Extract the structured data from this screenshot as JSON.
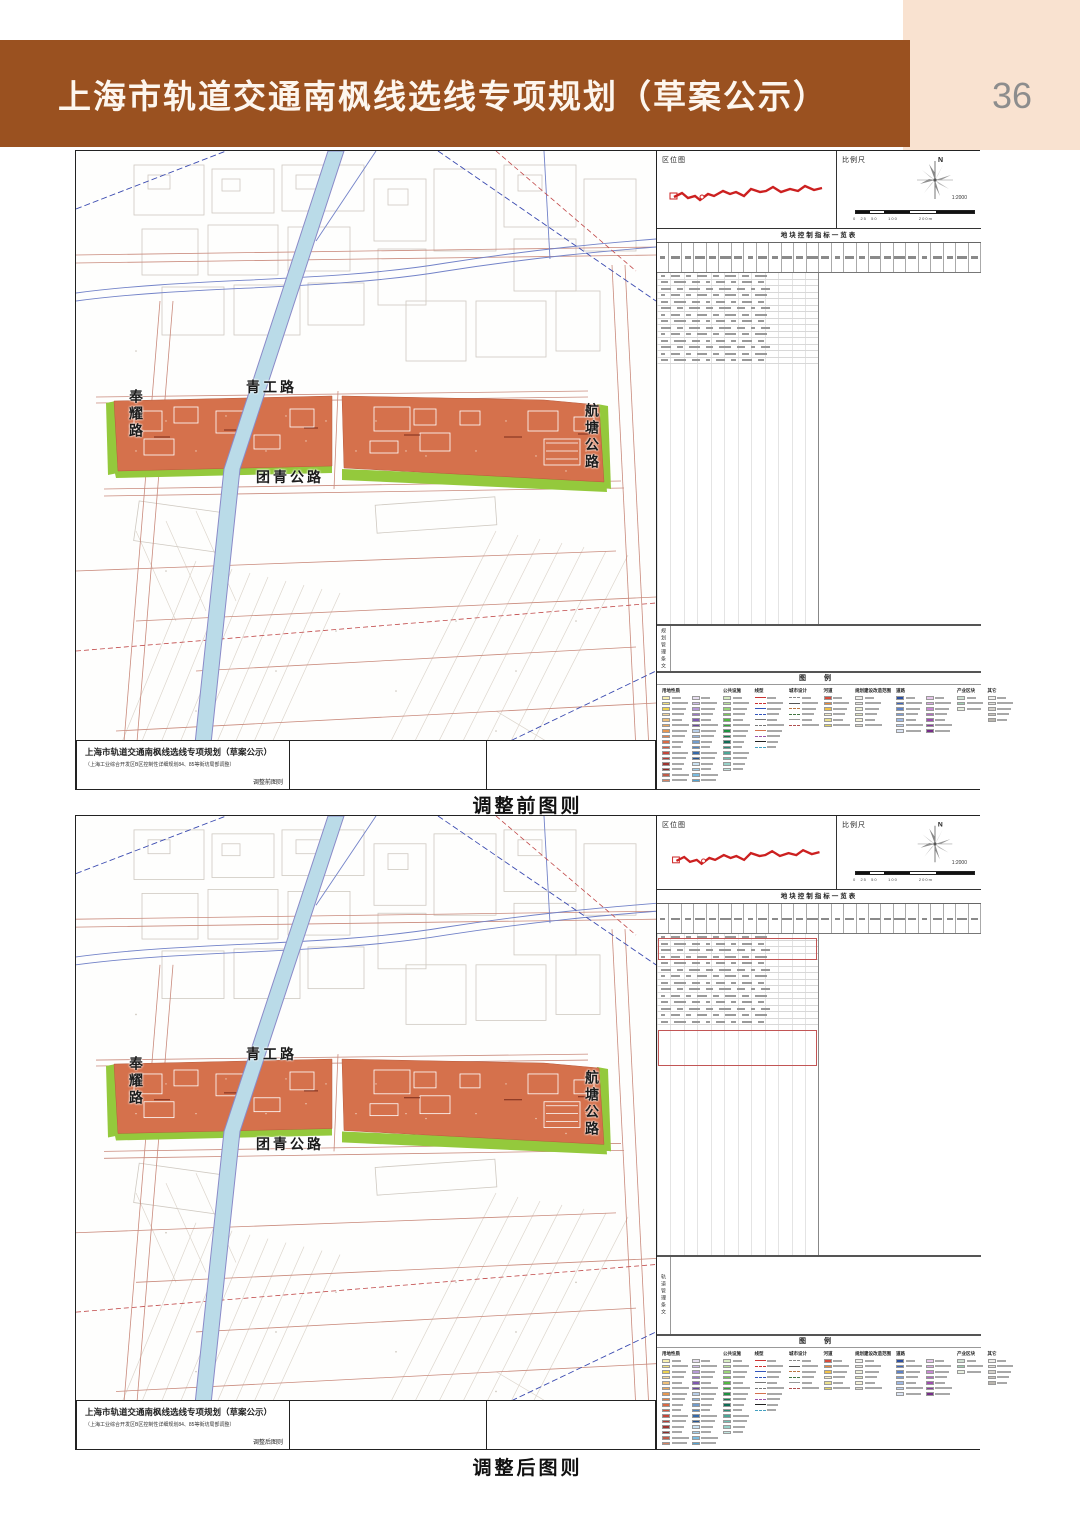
{
  "page": {
    "title": "上海市轨道交通南枫线选线专项规划（草案公示）",
    "page_number": "36"
  },
  "colors": {
    "header_brown": "#9a5120",
    "corner_peach": "#f9e2d0",
    "parcel_orange": "#d5714c",
    "greenbelt_green": "#94c93c",
    "canal_blue": "#badbe8",
    "route_red": "#cc2020"
  },
  "panels": [
    {
      "caption": "调整前图则",
      "location_map_label": "区位图",
      "scale_label": "比例尺",
      "north_label": "N",
      "scale_value": "1:2000",
      "scale_ticks": "0  25  50     100          200m",
      "table_title": "地块控制指标一览表",
      "conditions_label": "规划管理条文",
      "legend_title": "图 例",
      "roads": {
        "fengyao": "奉耀路",
        "qinggong": "青工路",
        "tuanqing": "团青公路",
        "hangtang": "航塘公路"
      },
      "titleblock": {
        "line1": "上海市轨道交通南枫线选线专项规划（草案公示）",
        "line2": "（上海工业综合开发区B区控制性详细规划84、85等街坊局部调整）",
        "line3": "调整前图则"
      }
    },
    {
      "caption": "调整后图则",
      "location_map_label": "区位图",
      "scale_label": "比例尺",
      "north_label": "N",
      "scale_value": "1:2000",
      "scale_ticks": "0  25  50     100          200m",
      "table_title": "地块控制指标一览表",
      "conditions_label": "轨道管理条文",
      "legend_title": "图 例",
      "roads": {
        "fengyao": "奉耀路",
        "qinggong": "青工路",
        "tuanqing": "团青公路",
        "hangtang": "航塘公路"
      },
      "titleblock": {
        "line1": "上海市轨道交通南枫线选线专项规划（草案公示）",
        "line2": "（上海工业综合开发区B区控制性详细规划84、85等街坊局部调整）",
        "line3": "调整后图则"
      }
    }
  ],
  "legend": {
    "sections": [
      {
        "title": "用地性质",
        "type": "swatch",
        "cols": [
          [
            "#f7efb0",
            "#f2e17f",
            "#ecd24f",
            "#f3d79c",
            "#efc079",
            "#eca85c",
            "#e79750",
            "#e1814b",
            "#da6a45",
            "#d2553f",
            "#c4463a",
            "#b23c35",
            "#9e3430",
            "#8a2b2b",
            "#c05c49",
            "#d68465"
          ],
          [
            "#e7def0",
            "#d0bde6",
            "#b699d6",
            "#9a75c4",
            "#7f58b1",
            "#68479c",
            "#b9cfe9",
            "#95b4da",
            "#719ccc",
            "#4f83bd",
            "#3569aa",
            "#265493",
            "#cbe3f3",
            "#a3d0ec",
            "#79bce1",
            "#53a4d2"
          ]
        ]
      },
      {
        "title": "公共设施",
        "type": "swatch",
        "cols": [
          [
            "#d8eec2",
            "#bae19d",
            "#9ad478",
            "#77c757",
            "#52b842",
            "#33a537",
            "#1e9140",
            "#137d4e",
            "#106b55",
            "#2b8c78",
            "#4ba697",
            "#70bfb2",
            "#98d3ca",
            "#c1e5df"
          ]
        ]
      },
      {
        "title": "线型",
        "type": "line",
        "cols": [
          [
            {
              "color": "#cc3333",
              "dash": false
            },
            {
              "color": "#cc3333",
              "dash": true
            },
            {
              "color": "#3355bb",
              "dash": false
            },
            {
              "color": "#3355bb",
              "dash": true
            },
            {
              "color": "#777777",
              "dash": false
            },
            {
              "color": "#777777",
              "dash": true
            },
            {
              "color": "#d5714c",
              "dash": false
            },
            {
              "color": "#9955aa",
              "dash": true
            },
            {
              "color": "#222222",
              "dash": false
            },
            {
              "color": "#44a0c0",
              "dash": true
            }
          ]
        ]
      },
      {
        "title": "城市设计",
        "type": "line",
        "cols": [
          [
            {
              "color": "#888888",
              "dash": true
            },
            {
              "color": "#555555",
              "dash": false
            },
            {
              "color": "#bb7744",
              "dash": true
            },
            {
              "color": "#447744",
              "dash": true
            },
            {
              "color": "#999999",
              "dash": false
            },
            {
              "color": "#b05050",
              "dash": true
            }
          ]
        ]
      },
      {
        "title": "河道",
        "type": "swatch",
        "cols": [
          [
            "#d84a3a",
            "#e8883a",
            "#f0c048",
            "#f5efcf",
            "#ece18f",
            "#e4d564"
          ]
        ]
      },
      {
        "title": "规划建设改造范围",
        "type": "swatch",
        "cols": [
          [
            "#f2f1ec",
            "#e6e4dc",
            "#eef0d8",
            "#e2e6c0",
            "#f6f3da",
            "#dcd8cc"
          ]
        ]
      },
      {
        "title": "道路",
        "type": "swatch",
        "cols": [
          [
            "#2a4da0",
            "#3f66b8",
            "#5d82c8",
            "#7d9ed8",
            "#9db8e4",
            "#bdd0ee",
            "#dce6f6"
          ],
          [
            "#e8c8ec",
            "#d9a8e0",
            "#c888d2",
            "#b468c2",
            "#9e4cb0",
            "#8a3a9c",
            "#762c88"
          ]
        ]
      },
      {
        "title": "产业区块",
        "type": "swatch",
        "cols": [
          [
            "#cfe0d2",
            "#9fd0b0",
            "#e8f0e0"
          ]
        ]
      },
      {
        "title": "其它",
        "type": "swatch",
        "cols": [
          [
            "#f0efec",
            "#e3e1db",
            "#d5d2cb",
            "#c7c3bb",
            "#b9b5ad"
          ]
        ]
      }
    ]
  }
}
